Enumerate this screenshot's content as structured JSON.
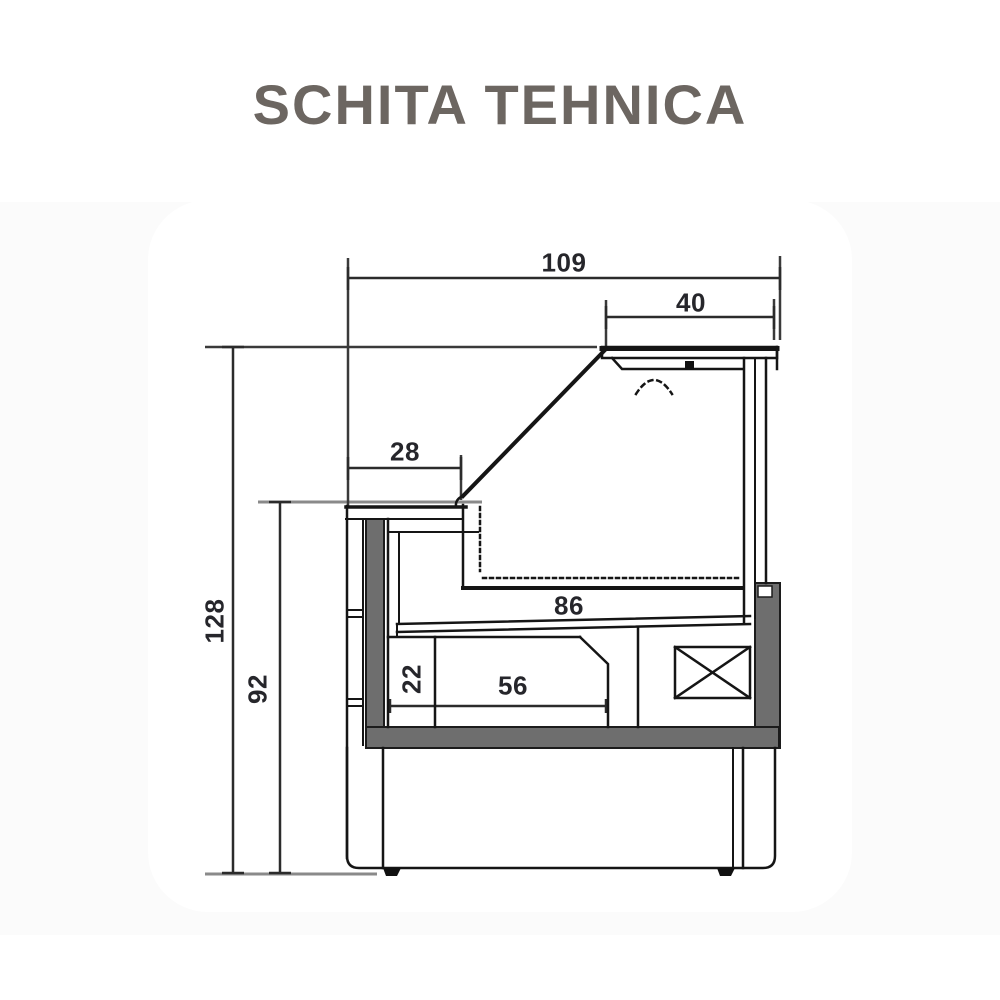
{
  "title": "SCHITA TEHNICA",
  "drawing": {
    "kind": "technical-cross-section",
    "dimensions": {
      "total_width": "109",
      "canopy_width": "40",
      "front_counter_depth": "28",
      "total_height": "128",
      "worktop_height": "92",
      "deck_width": "86",
      "compartment_height": "22",
      "compartment_width": "56"
    },
    "colors": {
      "line": "#151515",
      "panel_gray": "#6e6e6e",
      "extension_gray": "#8a8a8a",
      "dim_text": "#26262b",
      "title_gray": "#6c6661",
      "canvas": "#ffffff"
    }
  }
}
